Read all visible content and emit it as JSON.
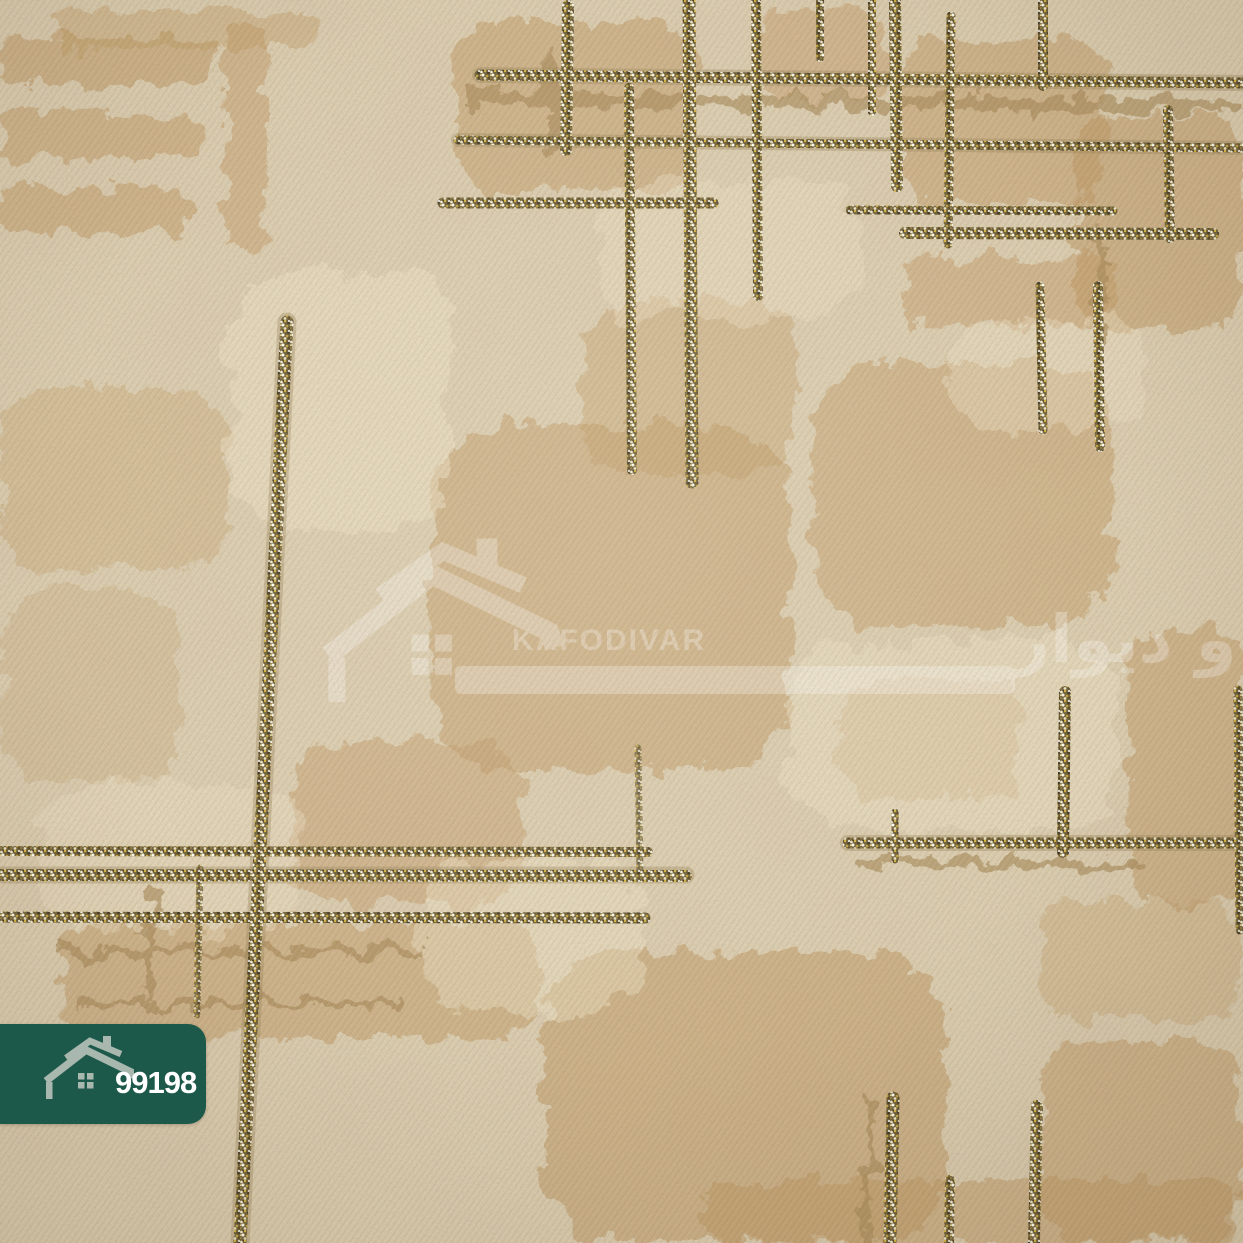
{
  "image": {
    "type": "wallpaper-product-photo",
    "subject": "Beige textured wallpaper sample with embossed tan patches and gold glitter plaid stripes"
  },
  "badge": {
    "code": "99198",
    "icon": "house-icon",
    "bg_color": "#1d594a",
    "icon_color": "#a9b8af",
    "text_color": "#ffffff"
  },
  "watermark": {
    "icon": "house-icon",
    "brand_latin": "KAFODIVAR",
    "brand_persian": "کف و دیوار",
    "color": "#ffffff",
    "opacity": 0.3
  },
  "palette": {
    "base_beige": "#dbcdb0",
    "light_cream": "#ecdfc3",
    "tan_patch": "#c09a66",
    "emboss_line": "#a98c5d",
    "glitter_base": "#6e5f38",
    "glitter_gold": "#d9b93f",
    "glitter_silver": "#f2ecd4",
    "glitter_dark": "#3f3621"
  }
}
